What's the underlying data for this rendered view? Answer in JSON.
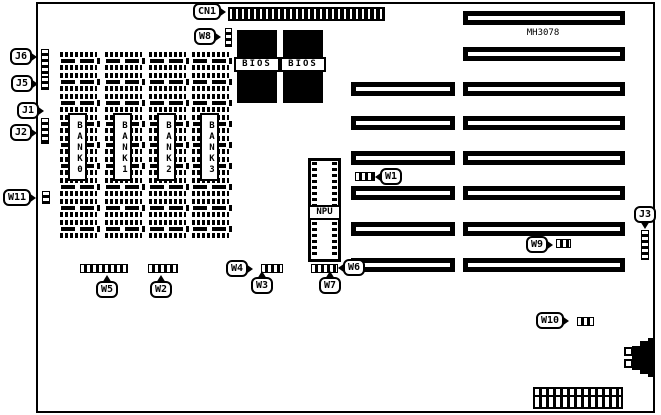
{
  "figure": {
    "type": "motherboard-jumper-location-diagram",
    "model": "MH3078",
    "ink_color": "#000000",
    "paper_color": "#ffffff"
  },
  "callouts": {
    "cn1": "CN1",
    "w1": "W1",
    "w2": "W2",
    "w3": "W3",
    "w4": "W4",
    "w5": "W5",
    "w6": "W6",
    "w7": "W7",
    "w8": "W8",
    "w9": "W9",
    "w10": "W10",
    "w11": "W11",
    "j1": "J1",
    "j2": "J2",
    "j3": "J3",
    "j5": "J5",
    "j6": "J6"
  },
  "components": {
    "bios1": "BIOS",
    "bios2": "BIOS",
    "npu": "NPU",
    "banks": [
      "BANK0",
      "BANK1",
      "BANK2",
      "BANK3"
    ],
    "model_silkscreen": "MH3078"
  },
  "memory": {
    "columns": 4,
    "rows_per_column": 9
  }
}
